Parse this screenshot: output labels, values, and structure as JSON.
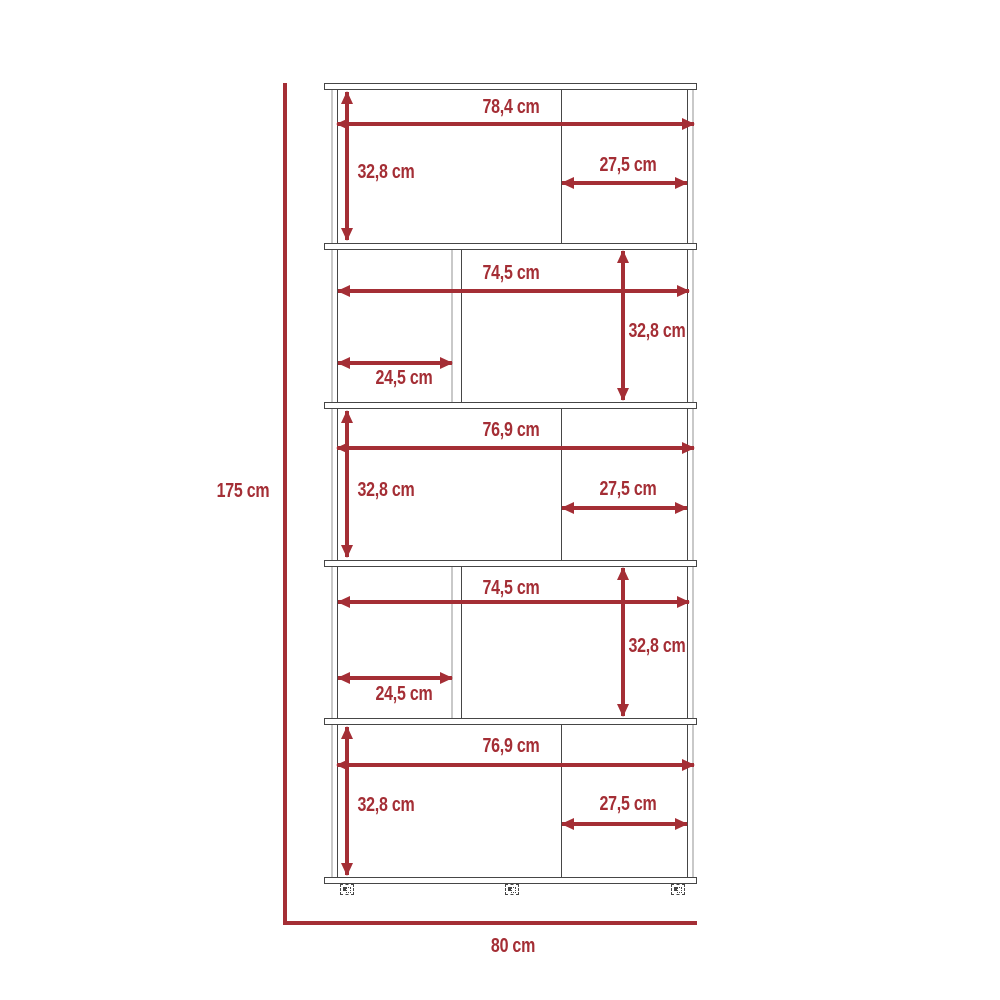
{
  "overall": {
    "height_label": "175 cm",
    "width_label": "80 cm"
  },
  "sections": [
    {
      "width_label": "78,4 cm",
      "height_label": "32,8 cm",
      "compartment_width_label": "27,5 cm"
    },
    {
      "width_label": "74,5 cm",
      "height_label": "32,8 cm",
      "compartment_width_label": "24,5 cm"
    },
    {
      "width_label": "76,9 cm",
      "height_label": "32,8 cm",
      "compartment_width_label": "27,5 cm"
    },
    {
      "width_label": "74,5 cm",
      "height_label": "32,8 cm",
      "compartment_width_label": "24,5 cm"
    },
    {
      "width_label": "76,9 cm",
      "height_label": "32,8 cm",
      "compartment_width_label": "27,5 cm"
    }
  ],
  "colors": {
    "dimension_red": "#a42e35",
    "outline_dark": "#464646",
    "outline_light": "#c9c9c9"
  }
}
